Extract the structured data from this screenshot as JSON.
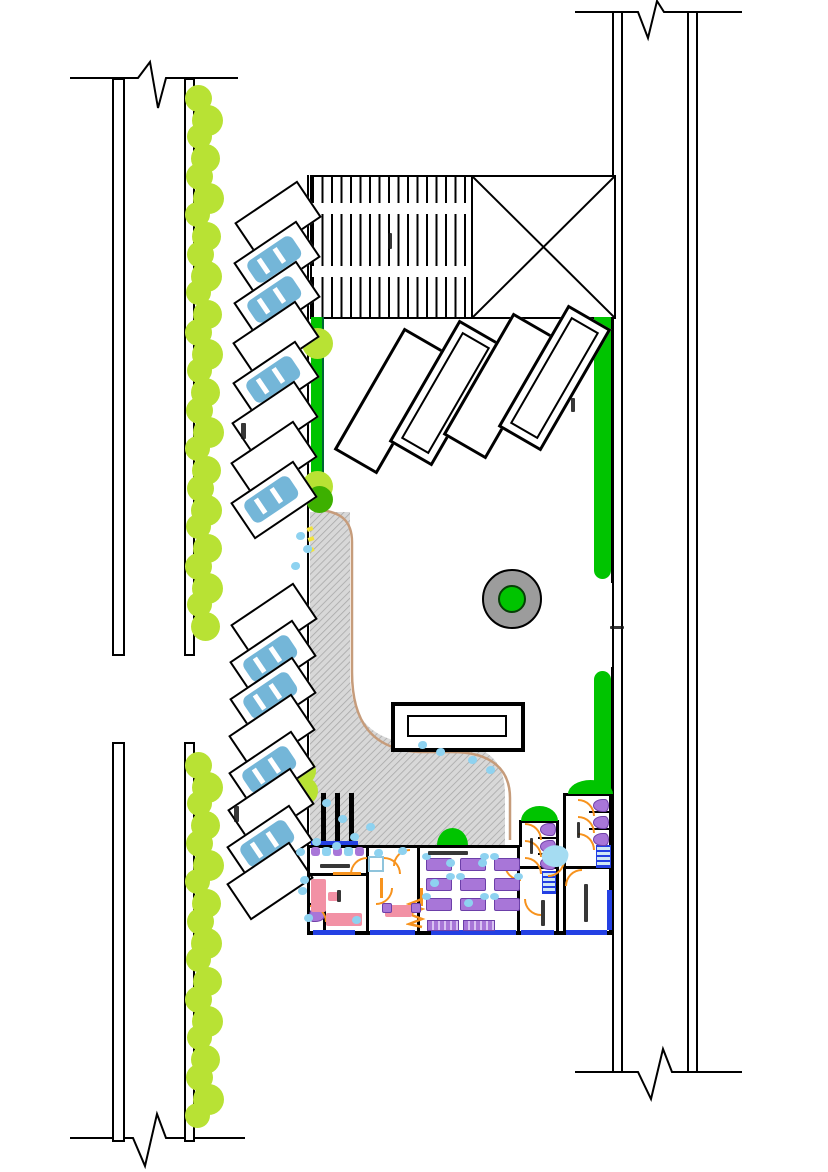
{
  "canvas": {
    "width": 828,
    "height": 1172,
    "background": "#ffffff"
  },
  "colors": {
    "line_black": "#000000",
    "green_strip": "#00C400",
    "tree_yellow_green": "#B8E234",
    "tree_dark_green": "#3DB000",
    "planter_ring_gray": "#9C9C9C",
    "paving_gray": "#D8D8D8",
    "paving_hatch": "#A8A8A8",
    "car_blue": "#74B6D8",
    "furniture_purple": "#A876D8",
    "desk_pink": "#F291A5",
    "door_orange": "#F7931E",
    "window_blue": "#2340E3",
    "people_blue": "#8ED2F0",
    "path_edge_tan": "#C69C7B",
    "accent_yellow": "#F2E43C"
  },
  "streets": {
    "left": {
      "lane_lines": 2,
      "segments": 2,
      "break_symbols": 2
    },
    "right": {
      "lane_lines": 4,
      "segments": 1,
      "break_symbols": 2,
      "curb_gap_dashes": 1
    }
  },
  "landscape": {
    "tree_columns": [
      {
        "count": 28
      },
      {
        "count": 19
      }
    ],
    "strip_trees": 2,
    "dark_trees": 1,
    "path_bushes": 2,
    "scatter_dots": 24,
    "planter_circle": {
      "rings": 2
    }
  },
  "parking": {
    "columns": [
      {
        "name": "north-row",
        "stalls": 8,
        "occupied": [
          1,
          2,
          4,
          7
        ]
      },
      {
        "name": "south-row",
        "stalls": 8,
        "occupied": [
          1,
          2,
          4,
          6
        ]
      }
    ]
  },
  "site": {
    "hatched_block_bands": 2,
    "crossed_block_diagonals": 2,
    "slabs": [
      {
        "double": false
      },
      {
        "double": true
      },
      {
        "double": false
      },
      {
        "double": true
      }
    ],
    "reflecting_pool_rectangles": 2,
    "bollard_bars": 3
  },
  "building": {
    "reception_chairs": 5,
    "classroom": {
      "desk_rows": 3,
      "desk_cols": 3,
      "long_desks": 2
    },
    "toilet_stacks": [
      {
        "count": 3
      },
      {
        "count": 3
      }
    ],
    "closet_toilets": 1,
    "door_arcs": 15,
    "door_leaves": 3,
    "window_segments": 7,
    "green_roof_domes": 3
  },
  "annotation_marks": 12
}
